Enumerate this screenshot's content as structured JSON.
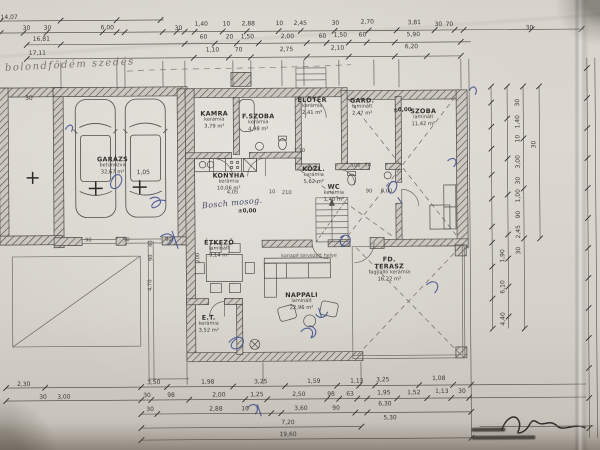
{
  "rooms": {
    "garazs": {
      "name": "GARÁZS",
      "material": "betonozva",
      "area": "32,67 m²"
    },
    "kamra": {
      "name": "KAMRA",
      "material": "kerámia",
      "area": "3,79 m²"
    },
    "fszoba": {
      "name": "F.SZOBA",
      "material": "kerámia",
      "area": "4,98 m²"
    },
    "eloter": {
      "name": "ELŐTÉR",
      "material": "kerámia",
      "area": "2,41 m²"
    },
    "gard": {
      "name": "GARD.",
      "material": "laminált",
      "area": "2,47 m²"
    },
    "szoba": {
      "name": "SZOBA",
      "material": "laminált",
      "area": "11,42 m²"
    },
    "konyha": {
      "name": "KONYHA",
      "material": "kerámia",
      "area": "10,06 m²"
    },
    "kozl": {
      "name": "KÖZL.",
      "material": "kerámia",
      "area": "5,62 m²"
    },
    "wc": {
      "name": "WC",
      "material": "kerámia",
      "area": "1,40 m²"
    },
    "etkezo": {
      "name": "ÉTKEZŐ",
      "material": "laminált",
      "area": "9,14 m²"
    },
    "et": {
      "name": "E.T.",
      "material": "kerámia",
      "area": "3,52 m²"
    },
    "nappali": {
      "name": "NAPPALI",
      "material": "laminált",
      "area": "22,96 m²"
    },
    "terasz": {
      "name": "FD. TERASZ",
      "material": "fagyálló kerámia",
      "area": "16,22 m²"
    }
  },
  "annotations": {
    "pencil_note": "bolondfödém szedés",
    "bosch_note": "Bosch mosog.",
    "sofa_note": "kanapé tervezett helye",
    "level_0_entry": "±0,00",
    "level_0_kitchen": "±0,00"
  },
  "dims": {
    "d1407": "14,07",
    "d1681": "16,81",
    "d1711": "17,11",
    "top1": [
      "30",
      "30",
      "6,00",
      "30"
    ],
    "chainA": [
      "1,40",
      "10",
      "2,88",
      "10",
      "2,45",
      "30",
      "2,70"
    ],
    "chainB": [
      "60",
      "20",
      "1,50",
      "2,00",
      "60",
      "1,50",
      "60"
    ],
    "chainC": [
      "1,10",
      "70",
      "2,75",
      "2,10"
    ],
    "right_top": [
      "3,81",
      "30",
      "70",
      "5,90",
      "6,20"
    ],
    "far_right": "30",
    "left_small": [
      "30",
      "1,05"
    ],
    "sill": [
      "90",
      "90",
      "90"
    ],
    "inner": {
      "i210": "210",
      "i100": "100",
      "i70": "70",
      "i90": "90",
      "i600": "6,00",
      "i405": "4,05",
      "i10": "10",
      "i200": "200",
      "i110": "1,10"
    },
    "fence": [
      "40",
      "90",
      "4,70"
    ],
    "right_strip": [
      "30",
      "1,40",
      "10",
      "3,00",
      "30",
      "1,00",
      "90",
      "2,45",
      "30",
      "1,90",
      "6,10",
      "4,40",
      "30"
    ],
    "bottom1": [
      "3,50",
      "1,98",
      "3,25",
      "1,59",
      "1,13",
      "3,25",
      "1,08"
    ],
    "bottom2": [
      "30",
      "98",
      "2,00",
      "1,25",
      "2,50",
      "98",
      "63",
      "1,95",
      "1,52",
      "1,13",
      "30"
    ],
    "bottom3": [
      "30",
      "2,88",
      "10",
      "3,60",
      "90",
      "6,30",
      "5,30"
    ],
    "total1": "7,20",
    "total2": "19,60",
    "bl": [
      "2,30",
      "30",
      "3,00"
    ]
  }
}
